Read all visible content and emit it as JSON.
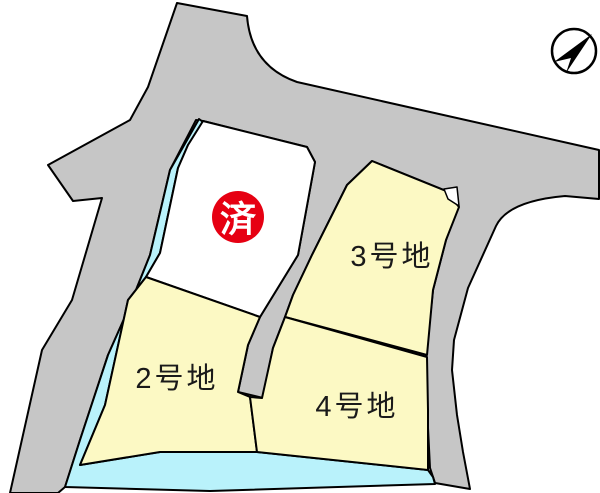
{
  "lots": {
    "sold": {
      "badge": "済"
    },
    "lot2": {
      "label": "2号地"
    },
    "lot3": {
      "label": "3号地"
    },
    "lot4": {
      "label": "4号地"
    }
  },
  "icons": {
    "north_arrow": "north-arrow"
  },
  "colors": {
    "road": "#c6c6c6",
    "lot_fill": "#fcf9c4",
    "water": "#b9f2fb",
    "sold_badge": "#e60012",
    "empty_lot": "#ffffff",
    "outline": "#000000"
  }
}
